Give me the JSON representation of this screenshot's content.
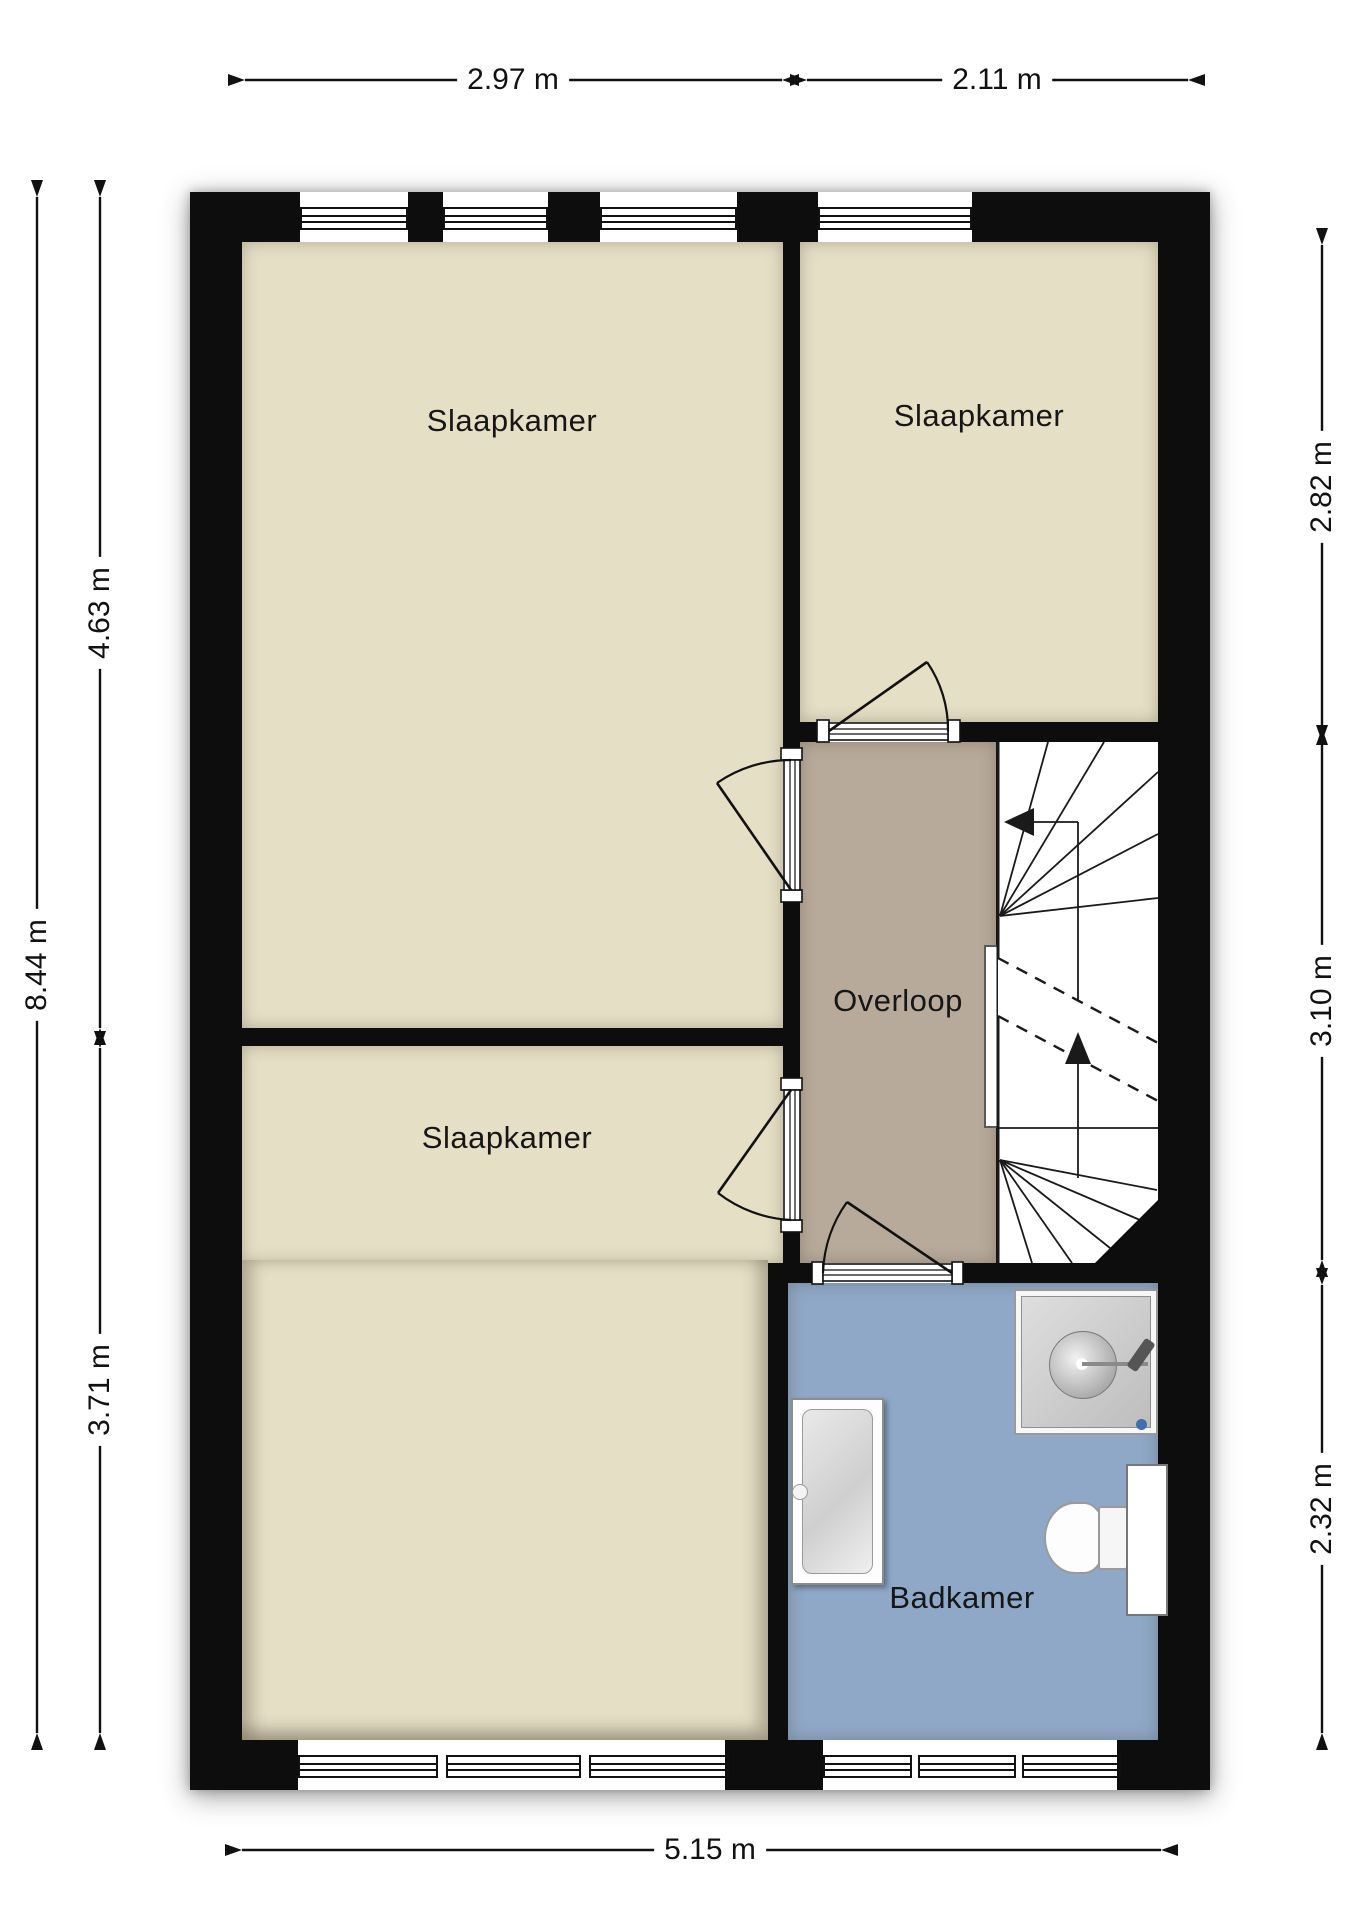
{
  "floorplan": {
    "rooms": [
      {
        "id": "slaapkamer-top-left",
        "label": "Slaapkamer"
      },
      {
        "id": "slaapkamer-top-right",
        "label": "Slaapkamer"
      },
      {
        "id": "slaapkamer-bottom-left",
        "label": "Slaapkamer"
      },
      {
        "id": "overloop",
        "label": "Overloop"
      },
      {
        "id": "badkamer",
        "label": "Badkamer"
      }
    ],
    "dimensions": {
      "top": [
        {
          "label": "2.97 m"
        },
        {
          "label": "2.11 m"
        }
      ],
      "left": [
        {
          "label": "8.44 m"
        },
        {
          "label": "4.63 m"
        },
        {
          "label": "3.71 m"
        }
      ],
      "right": [
        {
          "label": "2.82 m"
        },
        {
          "label": "3.10 m"
        },
        {
          "label": "2.32 m"
        }
      ],
      "bottom": [
        {
          "label": "5.15 m"
        }
      ]
    },
    "colors": {
      "bedroom": "#e5dfc6",
      "landing": "#b8aa9b",
      "bathroom": "#8fa8c8",
      "wall": "#0d0d0d"
    },
    "fixtures": [
      "stairs",
      "bathtub",
      "shower",
      "toilet",
      "railing",
      "cabinet"
    ],
    "doors": [
      "top-right-bedroom-door",
      "top-left-bedroom-door",
      "bottom-left-bedroom-door",
      "bathroom-door"
    ]
  }
}
